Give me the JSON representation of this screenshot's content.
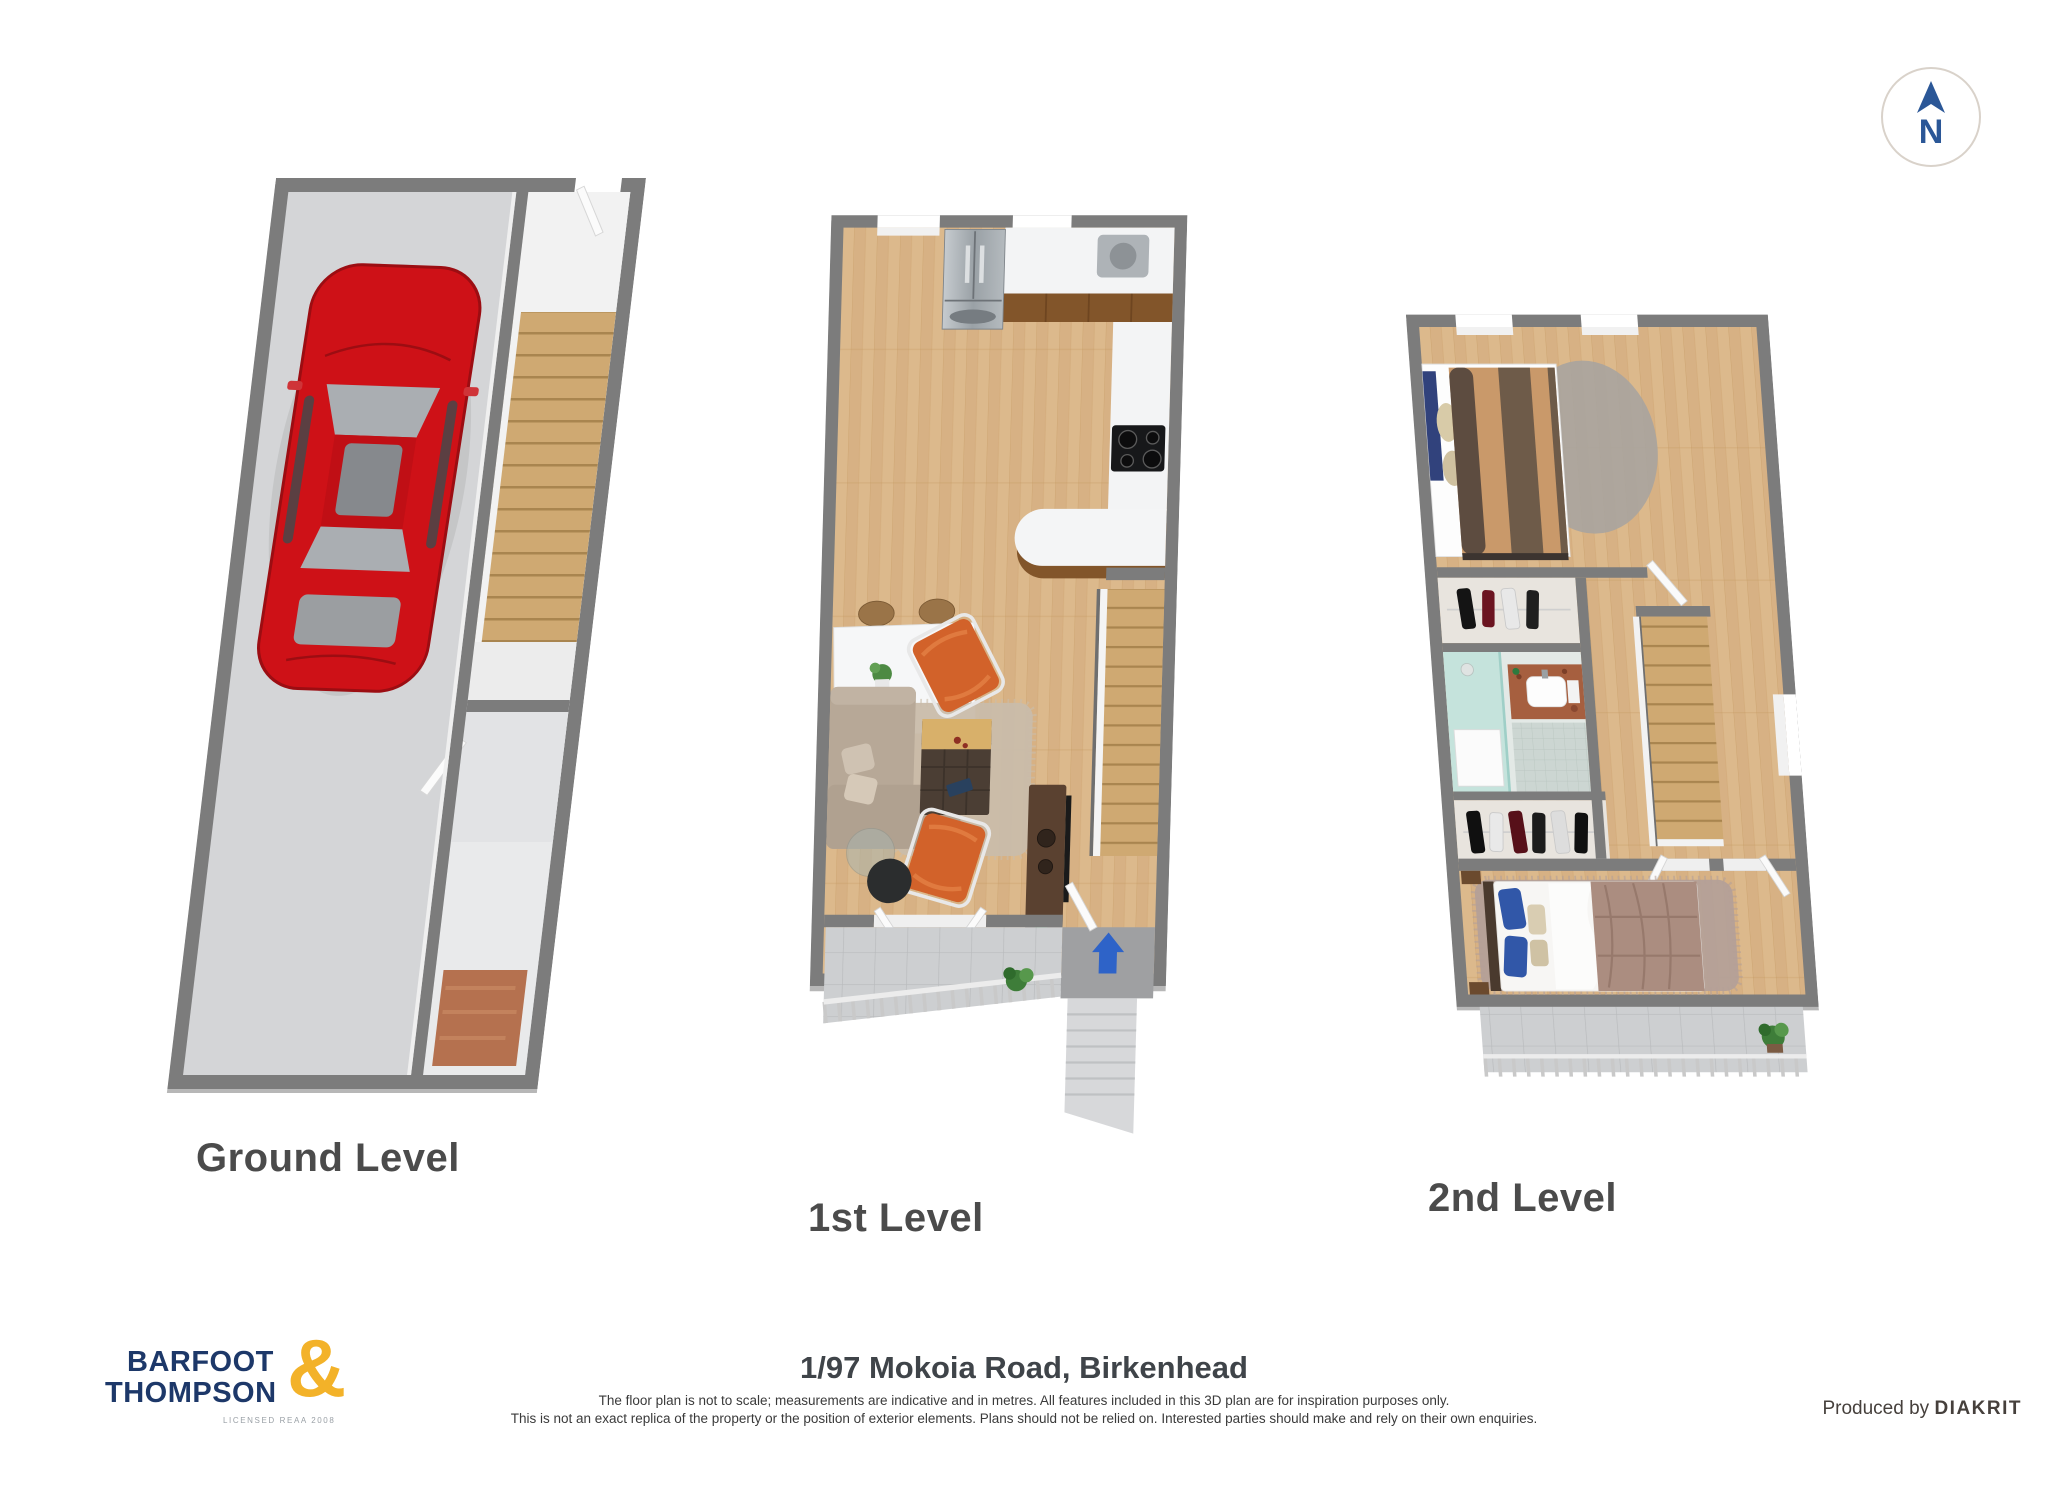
{
  "compass": {
    "letter": "N",
    "icon": "north-arrow-icon",
    "color": "#2b5797"
  },
  "plans": {
    "ground": {
      "label": "Ground Level",
      "contents": "garage with red car, internal staircase, storage"
    },
    "first": {
      "label": "1st Level",
      "contents": "kitchen, dining, living room, stairs, entry with arrow, deck"
    },
    "second": {
      "label": "2nd Level",
      "contents": "two bedrooms, wardrobe, bathroom, landing, balcony"
    }
  },
  "footer": {
    "address": "1/97 Mokoia Road, Birkenhead",
    "disclaimer1": "The floor plan is not to scale; measurements are indicative and in metres. All features included in this 3D plan are for inspiration purposes only.",
    "disclaimer2": "This is not an exact replica of the property or the position of exterior elements. Plans should not be relied on. Interested parties should make and rely on their own enquiries.",
    "produced_by": "Produced by ",
    "producer": "DIAKRIT"
  },
  "logo": {
    "word1": "BARFOOT",
    "word2": "THOMPSON",
    "ampersand": "&",
    "license": "LICENSED REAA 2008",
    "navy": "#1d3869",
    "gold": "#f3b229"
  },
  "colors": {
    "wall_gray": "#7c7c7c",
    "wall_bevel": "#b7b7b7",
    "wood_floor": "#dcb98c",
    "stair_wood": "#cfa972",
    "garage_floor": "#d4d5d7",
    "car_red": "#ce1117",
    "entry_arrow_blue": "#2e63c8",
    "orange_chair": "#d2622a",
    "sofa_beige": "#b7a897",
    "bathroom_aqua": "#c2e2db",
    "deck_tile": "#cdcfd1"
  },
  "icons": {
    "compass": "north-arrow-icon",
    "entry": "up-arrow-icon"
  }
}
